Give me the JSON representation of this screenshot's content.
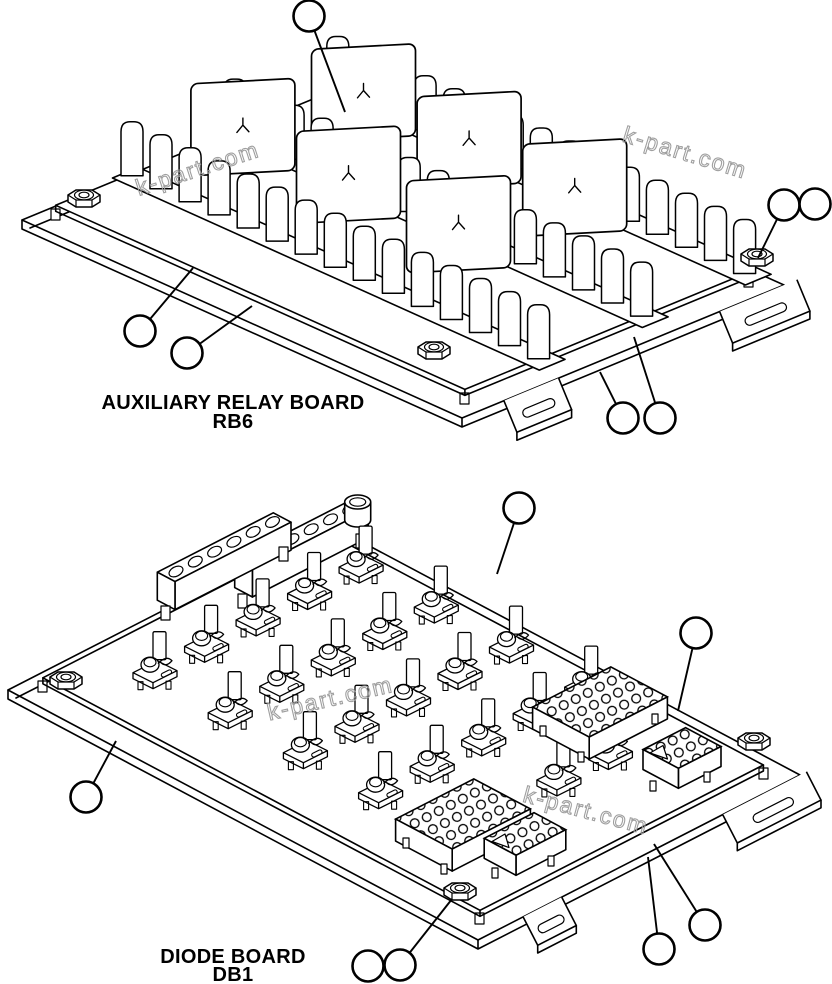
{
  "diagram": {
    "background": "#ffffff",
    "ink_color": "#000000",
    "balloon_radius": 15.5,
    "watermark": {
      "text": "k-part.com",
      "color": "#9a9a9a",
      "instances": [
        {
          "x": 200,
          "y": 176,
          "angle": -18
        },
        {
          "x": 683,
          "y": 160,
          "angle": 17
        },
        {
          "x": 332,
          "y": 706,
          "angle": -13
        },
        {
          "x": 584,
          "y": 818,
          "angle": 15
        }
      ]
    },
    "boards": [
      {
        "id": "rb6",
        "title": "AUXILIARY RELAY BOARD",
        "ref": "RB6",
        "callouts": [
          {
            "cx": 309,
            "cy": 16,
            "tx": 345,
            "ty": 112
          },
          {
            "cx": 784,
            "cy": 205,
            "tx": 758,
            "ty": 258
          },
          {
            "cx": 815,
            "cy": 204
          },
          {
            "cx": 140,
            "cy": 331,
            "tx": 193,
            "ty": 268
          },
          {
            "cx": 187,
            "cy": 353,
            "tx": 252,
            "ty": 306
          },
          {
            "cx": 623,
            "cy": 418,
            "tx": 600,
            "ty": 372
          },
          {
            "cx": 660,
            "cy": 418,
            "tx": 634,
            "ty": 337
          }
        ]
      },
      {
        "id": "db1",
        "title": "DIODE BOARD",
        "ref": "DB1",
        "callouts": [
          {
            "cx": 519,
            "cy": 508,
            "tx": 497,
            "ty": 574
          },
          {
            "cx": 696,
            "cy": 633,
            "tx": 678,
            "ty": 711
          },
          {
            "cx": 86,
            "cy": 797,
            "tx": 116,
            "ty": 741
          },
          {
            "cx": 368,
            "cy": 966
          },
          {
            "cx": 400,
            "cy": 965,
            "tx": 452,
            "ty": 899
          },
          {
            "cx": 659,
            "cy": 949,
            "tx": 648,
            "ty": 857
          },
          {
            "cx": 705,
            "cy": 925,
            "tx": 654,
            "ty": 844
          }
        ]
      }
    ]
  }
}
